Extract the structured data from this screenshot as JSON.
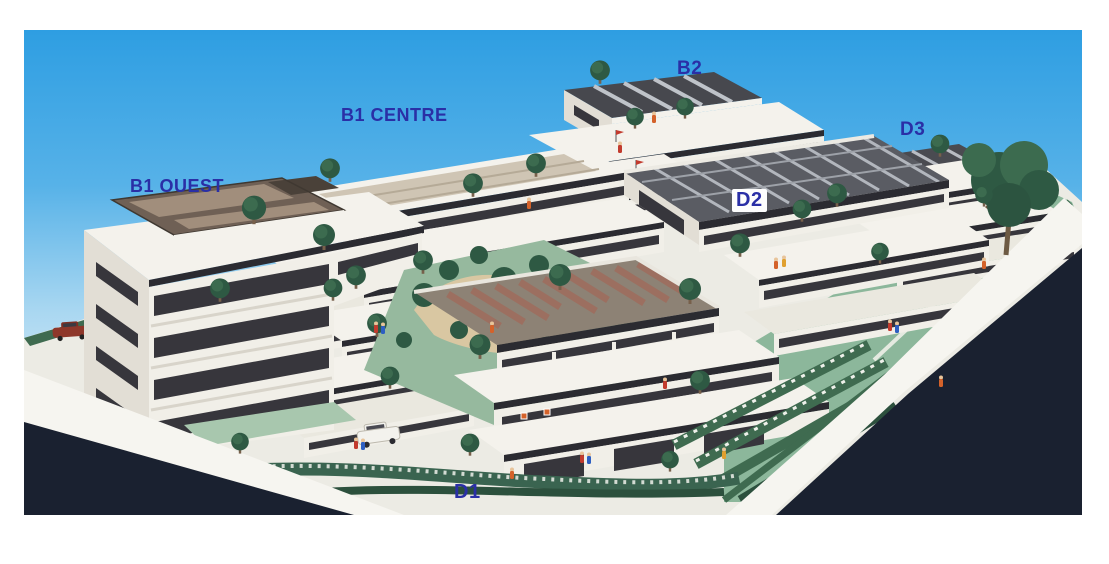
{
  "photo": {
    "alt": "Aerial photograph of an architectural scale model of a terraced apartment complex, with buildings labelled B1 OUEST, B1 CENTRE, B2, D2, D3 and D1",
    "labels": {
      "b1_ouest": "B1 OUEST",
      "b1_centre": "B1 CENTRE",
      "b2": "B2",
      "d3": "D3",
      "d2": "D2",
      "d1": "D1"
    },
    "colors": {
      "label_blue": "#2a2fa6",
      "label_box": "#fdfdfd",
      "sky_top": "#2e9ee2",
      "sky_horizon": "#e3f1f8",
      "road_dark": "#1a2130",
      "window_dark": "#37363c",
      "roof_brown": "#6f6055",
      "roof_panel": "#a18e7c",
      "solar_roof": "#5a5c63",
      "brick_roof": "#9c6f60",
      "tree_green": "#2e5943",
      "tree_light": "#3c6b4f",
      "lawn_green": "#8cb79b",
      "hedge_green": "#3f6b50",
      "sand_path": "#d9c7a2",
      "car_red": "#8e372a"
    }
  }
}
